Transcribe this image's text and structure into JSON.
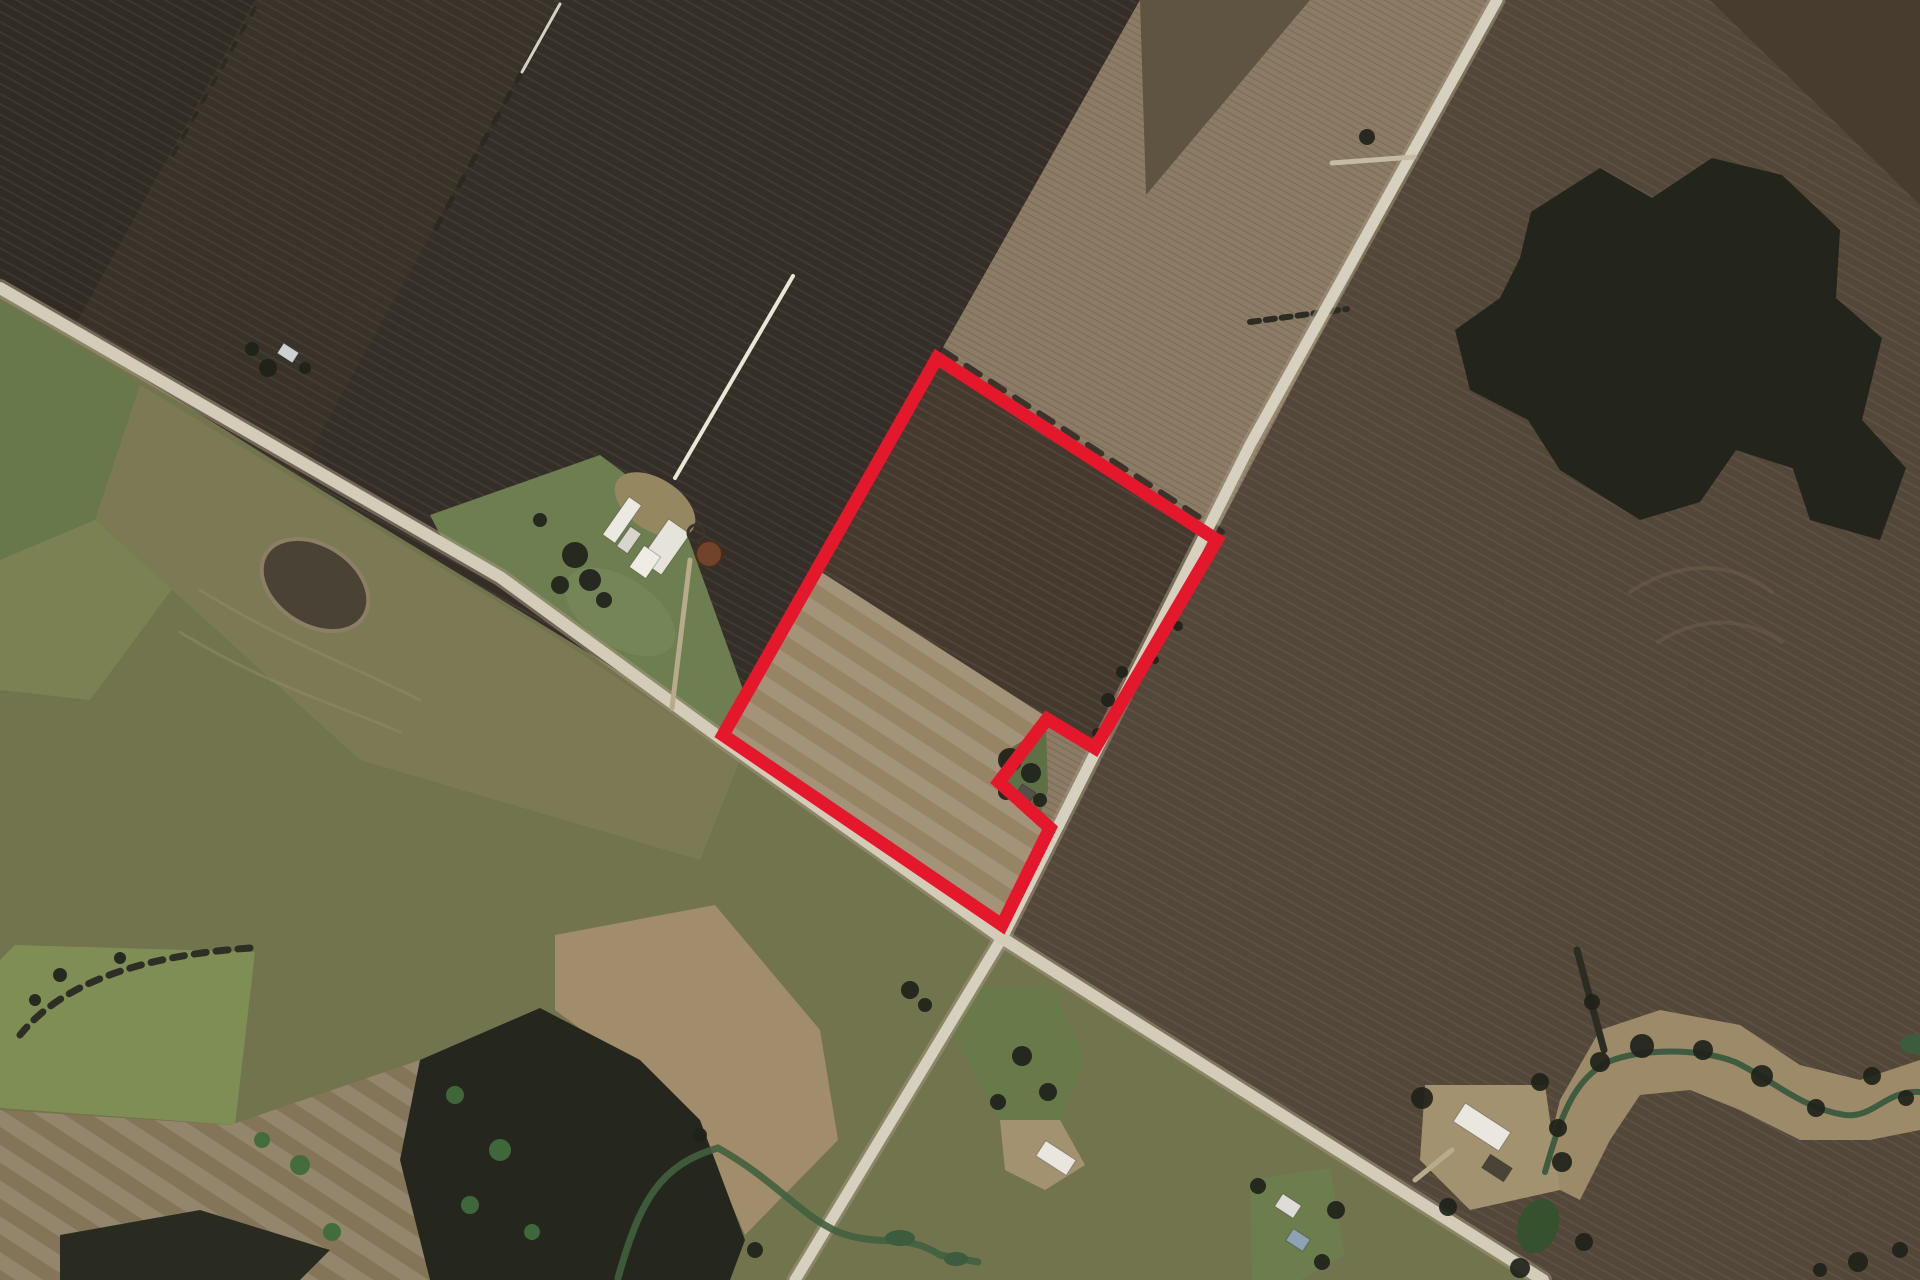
{
  "scene": {
    "width": 1920,
    "height": 1280,
    "background": "#473e33",
    "accent_red": "#e5182b",
    "patterns": [
      {
        "id": "pat-dark",
        "size": 9,
        "angle": 29,
        "band": 2,
        "c1": "rgba(255,255,255,0.05)",
        "c2": "rgba(0,0,0,0.06)"
      },
      {
        "id": "pat-fine",
        "size": 6,
        "angle": 29,
        "band": 1.5,
        "c1": "rgba(0,0,0,0.10)",
        "c2": "rgba(255,255,255,0.03)"
      },
      {
        "id": "pat-tan",
        "size": 30,
        "angle": 33,
        "band": 15,
        "c1": "rgba(255,255,255,0.12)",
        "c2": "rgba(0,0,0,0.06)"
      }
    ],
    "fields": [
      {
        "name": "zone-se-lowland",
        "points": "0,288 500,577 723,740 1002,938 1543,1280 0,1280",
        "fill": "#72744e"
      },
      {
        "name": "zone-ne-fields",
        "points": "1497,0 1920,0 1920,1280 1543,1280 1002,938",
        "fill": "#574b3c",
        "pattern": "pat-dark"
      },
      {
        "name": "strip-field-a",
        "points": "0,0 255,0 71,333 0,288",
        "fill": "#342e26",
        "pattern": "pat-dark"
      },
      {
        "name": "strip-field-b",
        "points": "255,0 560,0 297,475 71,333",
        "fill": "#3c352b",
        "pattern": "pat-dark"
      },
      {
        "name": "strip-field-c",
        "points": "560,0 1140,0 937,358 723,735 297,475",
        "fill": "#38312a",
        "pattern": "pat-dark"
      },
      {
        "name": "pale-striped-field",
        "points": "1140,0 1497,0 1002,938 1002,925 1050,828 999,782 1047,719 1095,748 1217,540 937,358",
        "fill": "#897860",
        "pattern": "pat-fine"
      },
      {
        "name": "pale-top-triangle",
        "points": "1140,0 1310,0 1146,195",
        "fill": "#5f5342"
      },
      {
        "name": "parcel-dark-field",
        "points": "937,358 1217,540 1095,748 815,568",
        "fill": "#493d31",
        "pattern": "pat-dark"
      },
      {
        "name": "parcel-tan-field",
        "points": "815,568 1095,748 1047,719 999,782 1050,828 1002,925 723,735",
        "fill": "#a08c6b",
        "pattern": "pat-tan"
      },
      {
        "name": "ne-corner-dark",
        "points": "1710,0 1920,0 1920,205",
        "fill": "#483c2f"
      },
      {
        "name": "forest-main",
        "points": "1531,212 1600,168 1652,198 1712,158 1782,175 1840,230 1836,298 1882,338 1862,420 1792,468 1736,450 1700,502 1640,520 1560,470 1528,420 1470,390 1455,330 1500,298 1520,258",
        "fill": "#23241b"
      },
      {
        "name": "forest-lump",
        "points": "1790,460 1862,420 1906,468 1880,540 1810,520",
        "fill": "#23241b"
      },
      {
        "name": "farm-lawn",
        "points": "430,515 600,455 680,515 745,695 725,740 520,585 448,550",
        "fill": "#6d7e50"
      },
      {
        "name": "pasture-left-1",
        "points": "0,300 140,385 95,520 0,560",
        "fill": "#67794b"
      },
      {
        "name": "pasture-left-2",
        "points": "0,560 95,520 175,585 90,700 0,690",
        "fill": "#7b8153"
      },
      {
        "name": "olive-mid-field",
        "points": "140,385 560,640 740,760 700,860 360,760 95,520",
        "fill": "#7b7a55"
      },
      {
        "name": "pasture-bright",
        "points": "15,945 255,952 235,1125 0,1108 0,960",
        "fill": "#7e8e55"
      },
      {
        "name": "tan-bottom-left",
        "points": "0,1110 230,1125 420,1060 470,1160 430,1280 0,1280",
        "fill": "#8d7c5e",
        "pattern": "pat-tan"
      },
      {
        "name": "sandy-wash",
        "points": "555,935 715,905 820,1030 838,1140 745,1235 690,1110 555,1010",
        "fill": "#a18d6b"
      },
      {
        "name": "forest-bottom",
        "points": "420,1060 540,1008 640,1060 700,1120 745,1240 730,1280 430,1280 400,1160",
        "fill": "#25261d"
      },
      {
        "name": "forest-bottom-strip",
        "points": "60,1235 200,1210 330,1250 300,1280 60,1280",
        "fill": "#2a2b20"
      },
      {
        "name": "creek-wash-right",
        "points": "1540,1180 1560,1100 1600,1030 1660,1010 1740,1025 1800,1065 1860,1080 1920,1060 1920,1130 1870,1140 1800,1140 1740,1110 1690,1090 1640,1095 1610,1140 1580,1200",
        "fill": "#9d8a69"
      },
      {
        "name": "farm2-yard",
        "points": "1425,1085 1545,1085 1560,1190 1470,1210 1420,1160",
        "fill": "#a3926f"
      },
      {
        "name": "farm1-lawn",
        "points": "963,987 1053,987 1085,1060 1060,1120 1000,1120 955,1040",
        "fill": "#68794a"
      },
      {
        "name": "farm1-yard",
        "points": "1000,1120 1060,1120 1085,1165 1045,1190 1005,1170",
        "fill": "#a3926f"
      },
      {
        "name": "farm3-lawn",
        "points": "1250,1180 1330,1168 1345,1255 1300,1280 1252,1280",
        "fill": "#6d7e4e"
      },
      {
        "name": "notch-lawn",
        "points": "1000,755 1046,726 1048,790 1040,815 1004,782",
        "fill": "#5f7046"
      }
    ],
    "hedges": [
      {
        "name": "hedge-strip-b",
        "d": "M545,30 L432,235",
        "stroke": "#2c2720",
        "width": 5,
        "dash": "10 14",
        "opacity": 0.9
      },
      {
        "name": "hedge-north-of-parcel",
        "d": "M942,350 L1222,532",
        "stroke": "#2e2820",
        "width": 6,
        "dash": "16 13",
        "opacity": 0.85
      },
      {
        "name": "hedge-pasture-bl",
        "d": "M250,948 Q80,960 20,1035",
        "stroke": "#2e2f24",
        "width": 7,
        "dash": "12 10",
        "opacity": 1
      },
      {
        "name": "hedge-forest-creek",
        "d": "M1577,950 L1604,1050",
        "stroke": "#2b2d22",
        "width": 7,
        "dash": "",
        "opacity": 1
      },
      {
        "name": "hedge-ne-road",
        "d": "M1250,322 L1347,309",
        "stroke": "#2b2d22",
        "width": 6,
        "dash": "9 7",
        "opacity": 1
      },
      {
        "name": "hedge-left-top",
        "d": "M255,8 L170,160",
        "stroke": "#2a251e",
        "width": 4,
        "dash": "8 12",
        "opacity": 0.7
      }
    ],
    "roads": [
      {
        "name": "road-ne-sw",
        "points": "1497,0 1250,445 1002,938 795,1280",
        "color": "#d6d0bf",
        "width": 11,
        "casing": "#a3967a",
        "casing_width": 17
      },
      {
        "name": "road-nw-se",
        "points": "0,288 500,577 723,740 1002,938 1543,1280",
        "color": "#d3ccb9",
        "width": 12,
        "casing": "#a3967a",
        "casing_width": 18
      }
    ],
    "overlays": [
      {
        "name": "white-field-line",
        "d": "M793,276 L675,478",
        "stroke": "#eae6d8",
        "width": 4,
        "opacity": 1
      },
      {
        "name": "white-field-line-top",
        "d": "M560,4 L522,72",
        "stroke": "#e6e2d4",
        "width": 3,
        "opacity": 0.9
      },
      {
        "name": "farm-driveway",
        "d": "M690,560 L672,708",
        "stroke": "#b7ab8c",
        "width": 5,
        "opacity": 1
      },
      {
        "name": "road-spur-top",
        "d": "M1414,157 L1332,163",
        "stroke": "#c4bba2",
        "width": 5,
        "opacity": 1
      },
      {
        "name": "field-track-1",
        "d": "M200,590 C280,640 340,660 420,700",
        "stroke": "#8e8a66",
        "width": 3,
        "opacity": 0.55
      },
      {
        "name": "field-track-2",
        "d": "M180,632 C260,682 330,702 400,732",
        "stroke": "#8e8a66",
        "width": 3,
        "opacity": 0.55
      },
      {
        "name": "field-arc-1",
        "d": "M1630,592 C1680,560 1730,560 1772,592",
        "stroke": "#6a5c49",
        "width": 4,
        "opacity": 0.6
      },
      {
        "name": "field-arc-2",
        "d": "M1658,642 C1700,616 1742,616 1782,642",
        "stroke": "#6a5c49",
        "width": 4,
        "opacity": 0.6
      },
      {
        "name": "creek-left",
        "d": "M618,1278 C640,1200 660,1165 718,1148 C775,1180 800,1215 838,1232 C880,1248 905,1232 940,1255 L978,1262",
        "stroke": "#41603f",
        "width": 7,
        "opacity": 0.9
      },
      {
        "name": "creek-right",
        "d": "M1545,1172 C1560,1120 1572,1080 1608,1062 C1640,1048 1700,1048 1735,1062 C1770,1078 1800,1108 1845,1115 C1875,1118 1885,1090 1920,1092",
        "stroke": "#3f5c40",
        "width": 6,
        "opacity": 1
      },
      {
        "name": "farm2-driveway",
        "d": "M1452,1150 L1415,1180",
        "stroke": "#b7ab8c",
        "width": 5,
        "opacity": 1
      }
    ],
    "ellipses": [
      {
        "name": "dark-soil-patch",
        "cx": 315,
        "cy": 585,
        "rx": 58,
        "ry": 40,
        "rot": 33,
        "fill": "#4a4234",
        "stroke": "#8d7f63",
        "sw": 4
      },
      {
        "name": "farm-yard-tan",
        "cx": 655,
        "cy": 505,
        "rx": 45,
        "ry": 26,
        "rot": 33,
        "fill": "#95875f"
      },
      {
        "name": "farm-lawn-bright",
        "cx": 620,
        "cy": 612,
        "rx": 62,
        "ry": 34,
        "rot": 33,
        "fill": "#75885a",
        "opacity": 0.8
      },
      {
        "name": "farm2-pond",
        "cx": 1538,
        "cy": 1226,
        "rx": 20,
        "ry": 28,
        "rot": 20,
        "fill": "#36512e"
      },
      {
        "name": "creek-pool-1",
        "cx": 900,
        "cy": 1238,
        "rx": 15,
        "ry": 8,
        "rot": 0,
        "fill": "#3c5c3d"
      },
      {
        "name": "creek-pool-2",
        "cx": 956,
        "cy": 1259,
        "rx": 12,
        "ry": 7,
        "rot": 0,
        "fill": "#3c5c3d"
      },
      {
        "name": "creek-pool-right",
        "cx": 1914,
        "cy": 1044,
        "rx": 14,
        "ry": 10,
        "rot": 0,
        "fill": "#3c5c3d"
      }
    ],
    "buildings": [
      {
        "name": "main-barn-long",
        "cx": 622,
        "cy": 520,
        "w": 46,
        "h": 15,
        "rot": -55,
        "fill": "#ece9e2"
      },
      {
        "name": "main-barn-small",
        "cx": 629,
        "cy": 540,
        "w": 24,
        "h": 13,
        "rot": -55,
        "fill": "#d9d5cc"
      },
      {
        "name": "main-barn-big",
        "cx": 665,
        "cy": 547,
        "w": 50,
        "h": 26,
        "rot": -55,
        "fill": "#e6e3db"
      },
      {
        "name": "main-farmhouse",
        "cx": 645,
        "cy": 562,
        "w": 26,
        "h": 20,
        "rot": -55,
        "fill": "#efece6"
      },
      {
        "name": "shed-northwest",
        "cx": 288,
        "cy": 353,
        "w": 18,
        "h": 12,
        "rot": 33,
        "fill": "#ccd2d4"
      },
      {
        "name": "farm1-barn",
        "cx": 1056,
        "cy": 1158,
        "w": 36,
        "h": 18,
        "rot": 33,
        "fill": "#e8e6de"
      },
      {
        "name": "farm2-barn",
        "cx": 1482,
        "cy": 1127,
        "w": 54,
        "h": 22,
        "rot": 33,
        "fill": "#e9e7e0"
      },
      {
        "name": "farm2-house",
        "cx": 1497,
        "cy": 1168,
        "w": 26,
        "h": 16,
        "rot": 33,
        "fill": "#4a4338"
      },
      {
        "name": "farm3-building",
        "cx": 1288,
        "cy": 1206,
        "w": 22,
        "h": 15,
        "rot": 33,
        "fill": "#dddcd8"
      },
      {
        "name": "farm3-blue-roof",
        "cx": 1298,
        "cy": 1240,
        "w": 20,
        "h": 14,
        "rot": 33,
        "fill": "#8da2b2"
      },
      {
        "name": "notch-shed",
        "cx": 1026,
        "cy": 793,
        "w": 16,
        "h": 11,
        "rot": 33,
        "fill": "#55504a"
      }
    ],
    "tanks": [
      {
        "name": "tank-ring",
        "cx": 696,
        "cy": 533,
        "r": 8,
        "fill": "none",
        "stroke": "#3a352c",
        "sw": 3
      },
      {
        "name": "rust-silo",
        "cx": 709,
        "cy": 554,
        "r": 13,
        "fill": "#71432a",
        "stroke": "#4a2c1a",
        "sw": 2
      }
    ],
    "trees": [
      [
        575,
        555,
        13
      ],
      [
        590,
        580,
        11
      ],
      [
        560,
        585,
        9
      ],
      [
        604,
        600,
        8
      ],
      [
        540,
        520,
        7
      ],
      [
        268,
        368,
        9
      ],
      [
        252,
        349,
        7
      ],
      [
        305,
        368,
        6
      ],
      [
        1010,
        760,
        12
      ],
      [
        1031,
        773,
        10
      ],
      [
        1006,
        792,
        8
      ],
      [
        1040,
        800,
        7
      ],
      [
        1108,
        700,
        7
      ],
      [
        1122,
        672,
        6
      ],
      [
        1097,
        733,
        5
      ],
      [
        1178,
        626,
        5
      ],
      [
        1155,
        660,
        4
      ],
      [
        1600,
        1062,
        10
      ],
      [
        1642,
        1046,
        12
      ],
      [
        1703,
        1050,
        10
      ],
      [
        1762,
        1076,
        11
      ],
      [
        1816,
        1108,
        9
      ],
      [
        1872,
        1076,
        9
      ],
      [
        1558,
        1128,
        9
      ],
      [
        1592,
        1002,
        8
      ],
      [
        1906,
        1098,
        8
      ],
      [
        1422,
        1098,
        11
      ],
      [
        1540,
        1082,
        9
      ],
      [
        1562,
        1162,
        10
      ],
      [
        1448,
        1207,
        9
      ],
      [
        1520,
        1268,
        10
      ],
      [
        1584,
        1242,
        9
      ],
      [
        1022,
        1056,
        10
      ],
      [
        1048,
        1092,
        9
      ],
      [
        998,
        1102,
        8
      ],
      [
        1258,
        1186,
        8
      ],
      [
        1336,
        1210,
        9
      ],
      [
        1322,
        1262,
        8
      ],
      [
        1858,
        1262,
        10
      ],
      [
        1900,
        1250,
        8
      ],
      [
        1820,
        1270,
        7
      ],
      [
        910,
        990,
        9
      ],
      [
        925,
        1005,
        7
      ],
      [
        60,
        975,
        7
      ],
      [
        35,
        1000,
        6
      ],
      [
        120,
        958,
        6
      ],
      [
        755,
        1250,
        8
      ],
      [
        700,
        1135,
        7
      ],
      [
        1367,
        137,
        8
      ]
    ],
    "tree_color": "#20221a",
    "conifers": [
      [
        455,
        1095,
        9
      ],
      [
        500,
        1150,
        11
      ],
      [
        470,
        1205,
        9
      ],
      [
        532,
        1232,
        8
      ],
      [
        300,
        1165,
        10
      ],
      [
        332,
        1232,
        9
      ],
      [
        262,
        1140,
        8
      ]
    ],
    "conifer_color": "#3f6b3c",
    "parcel_boundary": {
      "points": "937,358 1217,540 1095,748 1047,719 999,782 1050,828 1002,925 723,735",
      "color": "#e5182b",
      "width": 13
    }
  }
}
